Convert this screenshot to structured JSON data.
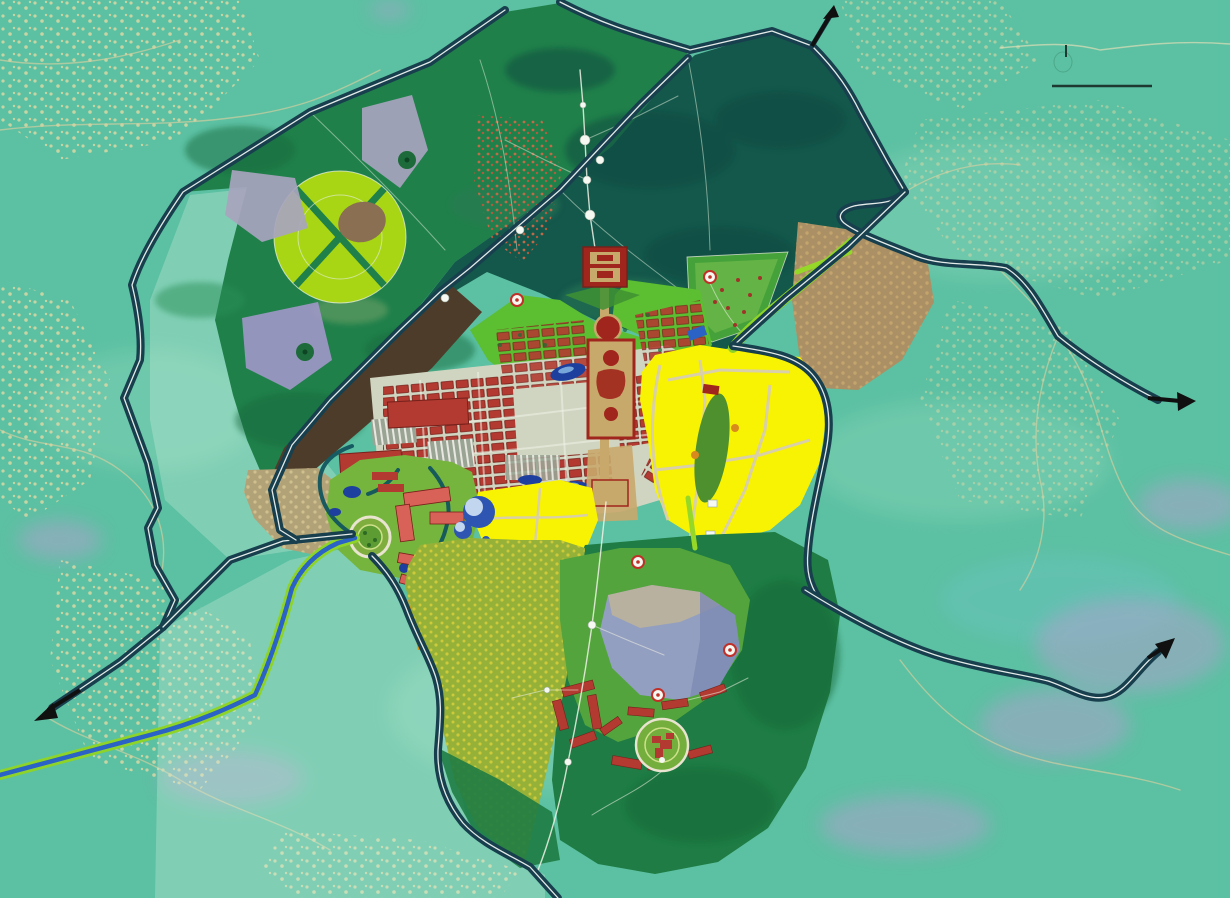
{
  "palette": {
    "bg": "#5cc0a2",
    "bgLight": "#85d3b6",
    "cream": "#d8cfa0",
    "creamDot": "#e3d9a6",
    "lavender": "#b1a0cf",
    "washLight": "#cdeede",
    "forestMid": "#20804a",
    "forestDark": "#14574b",
    "forestSouth": "#1e7c44",
    "parkGreen": "#5cbe31",
    "parkMid": "#53a43c",
    "brightStrip": "#96d827",
    "campusGreen": "#76b53d",
    "pinwheel": "#a8d614",
    "petalGrey": "#a8a4be",
    "petalPurple": "#9e97c6",
    "petalBrown": "#8a6f52",
    "olive": "#95b138",
    "oliveDot": "#dfd33a",
    "tanField": "#b2a277",
    "brownStrip": "#4e3c2b",
    "brownZone": "#aa9064",
    "yellow": "#f8f303",
    "yellowRoad": "#d9cfa8",
    "orange": "#d9990f",
    "orangeLight": "#e0aa1a",
    "roadDark": "#173f4d",
    "roadLine": "#eef3f0",
    "canal": "#11555e",
    "riverBlue": "#2a62c6",
    "riverBank": "#8ed428",
    "urbanRed": "#b23a31",
    "urbanDark": "#77211b",
    "street": "#cfd5c0",
    "axisTan": "#c8a96c",
    "templeRed": "#a0251c",
    "pink": "#d96258",
    "hillGrey": "#939fc0",
    "hillTan": "#bcb39b",
    "hillShade": "#7d8ab2",
    "lakeBlue": "#1d3f9e",
    "lakeLight": "#8fc0ea",
    "domeBlue": "#2e55b2",
    "domeLight": "#d4e4f5",
    "path": "#f0f2e6",
    "white": "#f6f8f2",
    "markerRing": "#c03028",
    "black": "#101010",
    "scalebar": "#1e3a30"
  },
  "map": {
    "type": "urban-master-plan",
    "orientation_arrows": [
      {
        "id": "arrow-north-exit",
        "direction": "north"
      },
      {
        "id": "arrow-east-exit",
        "direction": "east"
      },
      {
        "id": "arrow-southwest-exit",
        "direction": "southwest"
      },
      {
        "id": "arrow-southeast-exit",
        "direction": "northeast"
      }
    ],
    "scale_bar": {
      "segments": 1,
      "tick": true
    },
    "markers_count": 5,
    "features": [
      "regional-road-network",
      "northwest-plantation-forest",
      "pinwheel-recreation-park",
      "northeast-dense-forest",
      "existing-village-cluster",
      "ceremonial-axis-and-temple",
      "central-urban-blocks",
      "greenhouse-plots",
      "east-expansion-zone",
      "central-expansion-zone",
      "campus-cluster",
      "reservoir-strip",
      "east-orchard-zone",
      "river-corridor",
      "south-agricultural-district",
      "south-hill-park",
      "south-village-rows"
    ]
  }
}
